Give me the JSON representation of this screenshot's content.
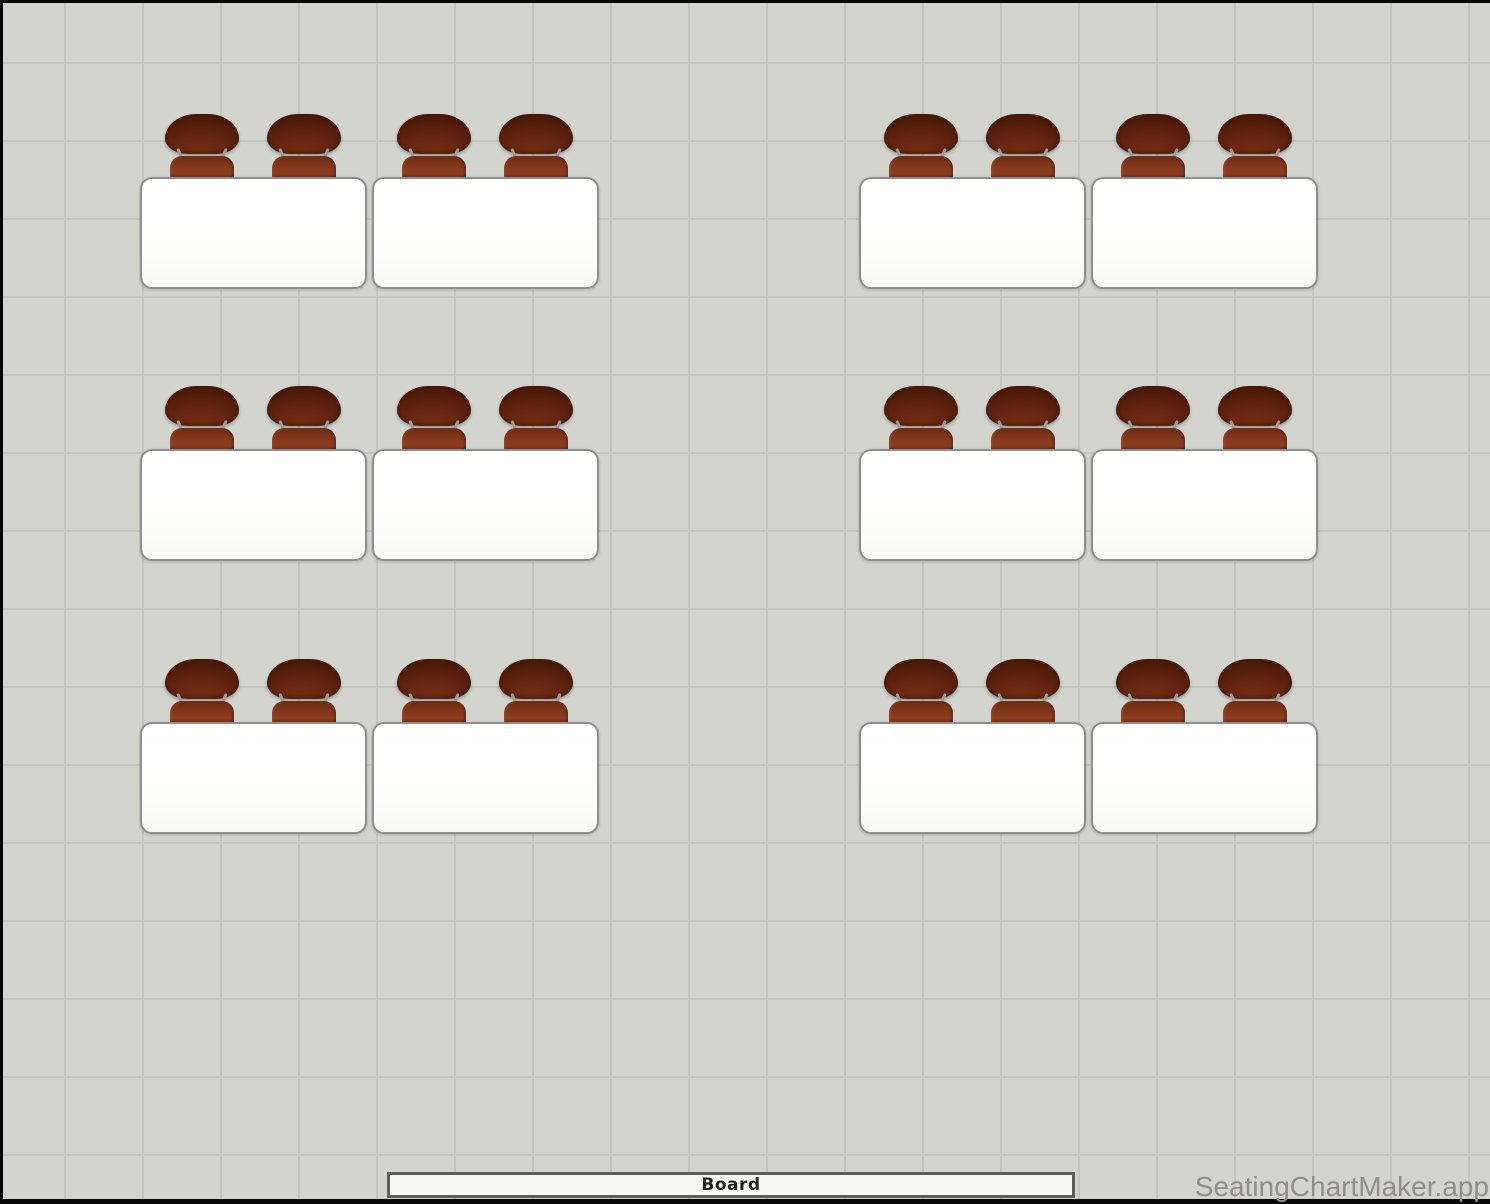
{
  "app": {
    "watermark": "SeatingChartMaker.app"
  },
  "board": {
    "label": "Board"
  },
  "seating": {
    "desk_count": 12,
    "seats_per_desk": 2,
    "total_seats": 24,
    "rows": 3,
    "desk_groups_per_row": 2,
    "desks_per_group": 2,
    "desks": [
      {
        "id": 1,
        "x": 140,
        "y": 177
      },
      {
        "id": 2,
        "x": 372,
        "y": 177
      },
      {
        "id": 3,
        "x": 859,
        "y": 177
      },
      {
        "id": 4,
        "x": 1091,
        "y": 177
      },
      {
        "id": 5,
        "x": 140,
        "y": 449
      },
      {
        "id": 6,
        "x": 372,
        "y": 449
      },
      {
        "id": 7,
        "x": 859,
        "y": 449
      },
      {
        "id": 8,
        "x": 1091,
        "y": 449
      },
      {
        "id": 9,
        "x": 140,
        "y": 722
      },
      {
        "id": 10,
        "x": 372,
        "y": 722
      },
      {
        "id": 11,
        "x": 859,
        "y": 722
      },
      {
        "id": 12,
        "x": 1091,
        "y": 722
      }
    ]
  },
  "colors": {
    "canvas_background": "#d4d4ce",
    "grid_line": "#c5c5bf",
    "desk_fill": "#ffffff",
    "desk_border": "#8e8e8e",
    "chair_backrest_dark": "#351005",
    "chair_backrest_light": "#7d3117",
    "chair_seat": "#8c3c1f",
    "chair_strut": "#9c9c96",
    "board_fill": "#f8f8f3",
    "board_border": "#5e5e58",
    "board_text": "#1f1f1f",
    "watermark_text": "#8f8f88",
    "frame_border": "#060606"
  }
}
